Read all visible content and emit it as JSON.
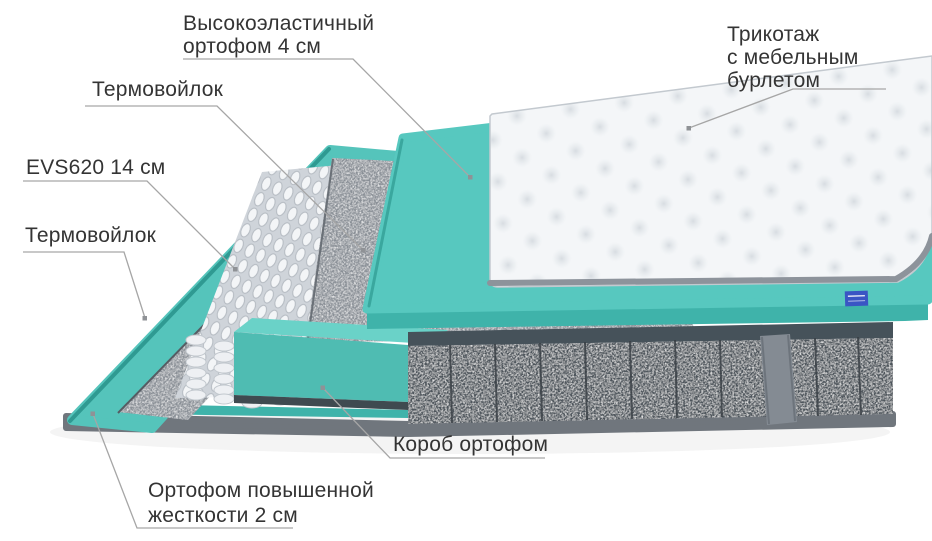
{
  "labels": {
    "elastic_foam": {
      "lines": [
        "Высокоэластичный",
        "ортофом 4 см"
      ]
    },
    "knit_cover": {
      "lines": [
        "Трикотаж",
        "с мебельным",
        "бурлетом"
      ]
    },
    "thermo_felt_top": {
      "lines": [
        "Термовойлок"
      ]
    },
    "evs_springs": {
      "lines": [
        "EVS620 14 см"
      ]
    },
    "thermo_felt_bottom": {
      "lines": [
        "Термовойлок"
      ]
    },
    "foam_box": {
      "lines": [
        "Короб ортофом"
      ]
    },
    "hard_foam": {
      "lines": [
        "Ортофом повышенной",
        "жесткости 2 см"
      ]
    }
  },
  "colors": {
    "teal_foam": "#57c8bf",
    "teal_foam_face": "#3fb3aa",
    "teal_base": "#55c4bb",
    "teal_dark_edge": "#2f9a92",
    "korob_front": "#4fbcb2",
    "korob_top": "#6ad2c8",
    "felt_gray": "#8a9097",
    "felt_dark_band": "#46525a",
    "dark_side": "#4d545c",
    "rim_gray": "#70767d",
    "quilt_white": "#f4f6f8",
    "quilt_edge": "#8d939b",
    "label_text": "#343434",
    "leader_line": "#a6a6a6",
    "tag_blue": "#3a55c4"
  }
}
